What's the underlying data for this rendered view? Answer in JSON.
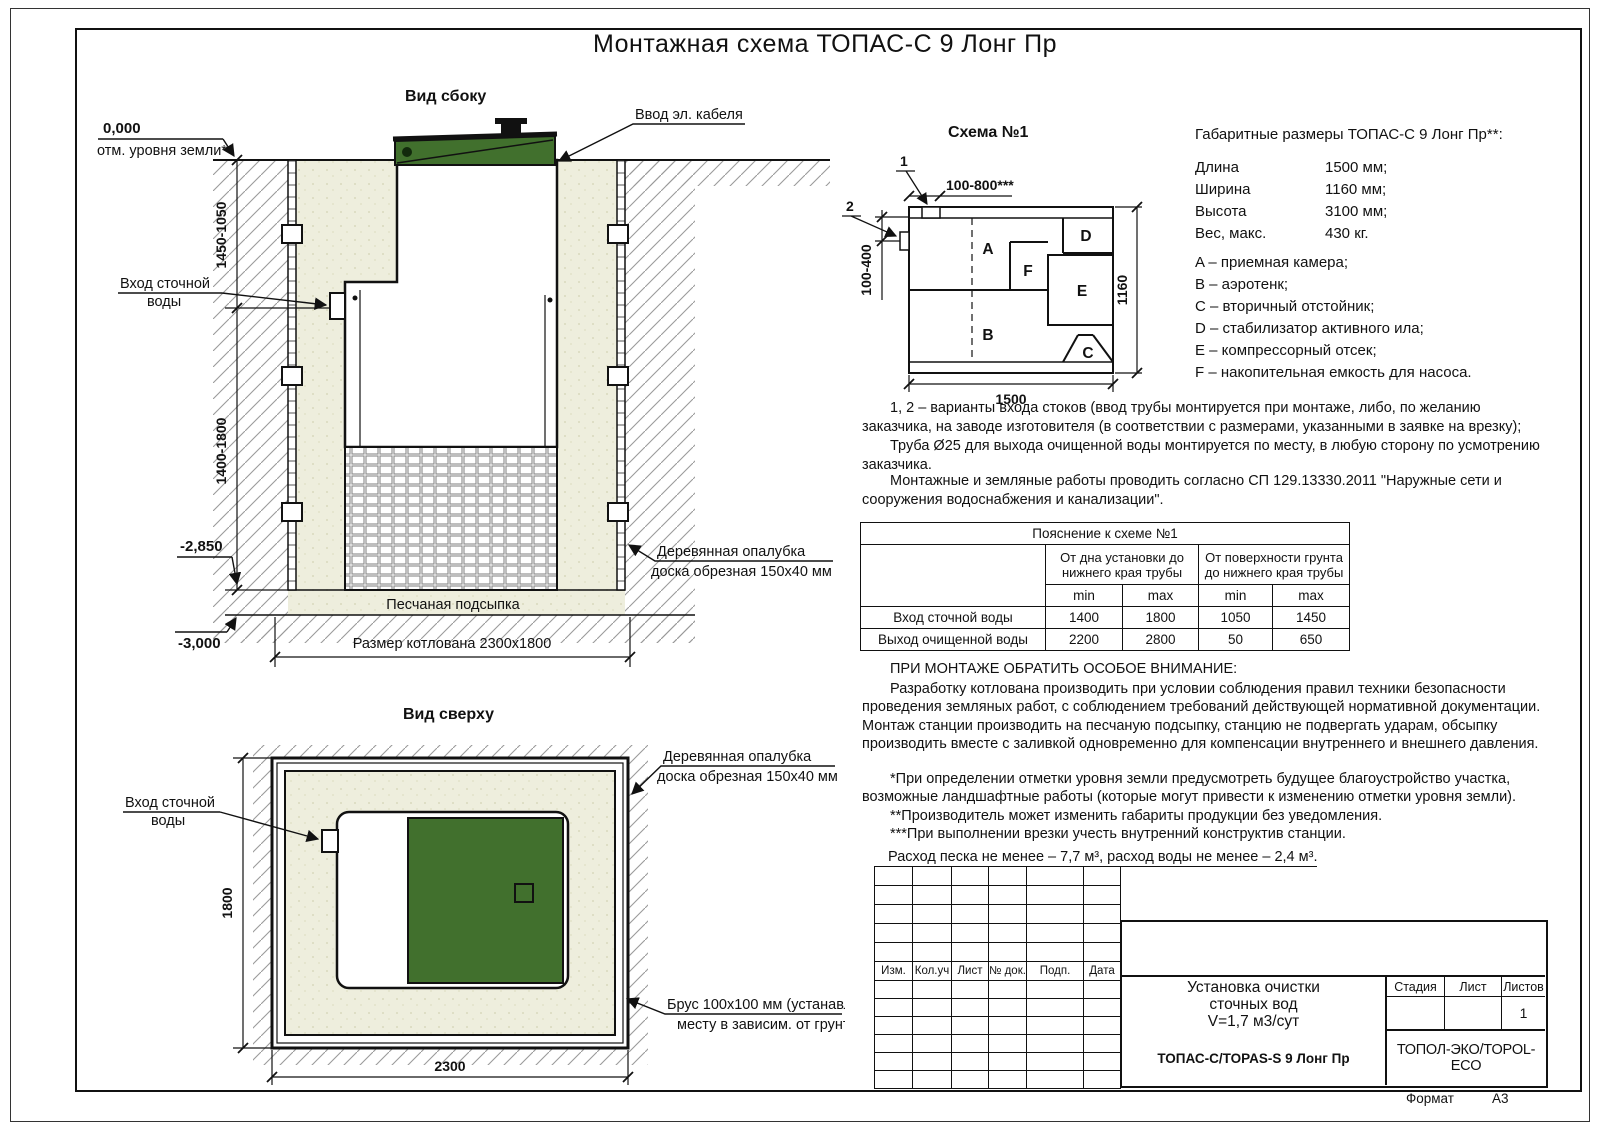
{
  "colors": {
    "green": "#41702d",
    "sand": "#eeeedd",
    "line": "#111111"
  },
  "sheet": {
    "title": "Монтажная схема ТОПАС-С 9 Лонг Пр",
    "format_label": "Формат",
    "format_value": "А3"
  },
  "side_view": {
    "view_label": "Вид сбоку",
    "zero_mark": "0,000",
    "zero_sub": "отм. уровня земли*",
    "cable_label": "Ввод эл. кабеля",
    "dim_upper": "1450-1050",
    "dim_lower": "1400-1800",
    "inlet1": "Вход сточной",
    "inlet2": "воды",
    "mark_2850": "-2,850",
    "mark_3000": "-3,000",
    "formwork1": "Деревянная опалубка",
    "formwork2": "доска обрезная 150х40 мм",
    "sand_label": "Песчаная подсыпка",
    "pit_label": "Размер котлована 2300х1800"
  },
  "top_view": {
    "view_label": "Вид сверху",
    "inlet1": "Вход сточной",
    "inlet2": "воды",
    "formwork1": "Деревянная опалубка",
    "formwork2": "доска обрезная 150х40 мм",
    "beam1": "Брус 100х100 мм (устанавл. по",
    "beam2": "месту в зависим. от грунта)",
    "dim_h": "1800",
    "dim_w": "2300"
  },
  "schema1": {
    "title": "Схема №1",
    "mark1": "1",
    "mark2": "2",
    "dim_top": "100-800***",
    "dim_left": "100-400",
    "dim_bottom": "1500",
    "dim_right": "1160",
    "comp": {
      "a": "A",
      "b": "B",
      "c": "C",
      "d": "D",
      "e": "E",
      "f": "F"
    }
  },
  "overall_dims": {
    "title": "Габаритные размеры ТОПАС-С 9 Лонг Пр**:",
    "rows": [
      {
        "name": "Длина",
        "value": "1500 мм;"
      },
      {
        "name": "Ширина",
        "value": "1160 мм;"
      },
      {
        "name": "Высота",
        "value": "3100 мм;"
      },
      {
        "name": "Вес, макс.",
        "value": "430 кг."
      }
    ]
  },
  "legend": {
    "items": [
      "A – приемная камера;",
      "B – аэротенк;",
      "C – вторичный отстойник;",
      "D – стабилизатор активного ила;",
      "E – компрессорный отсек;",
      "F – накопительная емкость для насоса."
    ]
  },
  "notes": {
    "variants": "1, 2 – варианты входа  стоков (ввод трубы монтируется при монтаже, либо, по желанию заказчика, на заводе изготовителя (в соответствии с размерами, указанными в заявке на врезку);",
    "pipe": "Труба Ø25 для выхода очищенной воды монтируется по месту, в любую сторону по усмотрению заказчика.",
    "works": "Монтажные и земляные работы проводить согласно СП 129.13330.2011 \"Наружные сети и сооружения водоснабжения и канализации\"."
  },
  "table": {
    "title": "Пояснение к схеме №1",
    "group1": "От дна установки до нижнего края трубы",
    "group2": "От поверхности грунта до нижнего края трубы",
    "min_label": "min",
    "max_label": "max",
    "rows": [
      {
        "name": "Вход сточной воды",
        "v1": "1400",
        "v2": "1800",
        "v3": "1050",
        "v4": "1450"
      },
      {
        "name": "Выход очищенной воды",
        "v1": "2200",
        "v2": "2800",
        "v3": "50",
        "v4": "650"
      }
    ]
  },
  "attention": {
    "title": "ПРИ МОНТАЖЕ ОБРАТИТЬ ОСОБОЕ ВНИМАНИЕ:",
    "p1": "Разработку котлована производить при условии соблюдения правил техники безопасности проведения земляных работ, с соблюдением требований действующей нормативной документации. Монтаж станции производить на песчаную подсыпку, станцию не подвергать ударам, обсыпку производить вместе с заливкой одновременно для компенсации внутреннего и внешнего давления.",
    "note1": "*При определении отметки уровня земли предусмотреть будущее благоустройство участка, возможные ландшафтные работы (которые могут привести к изменению отметки уровня земли).",
    "note2": "**Производитель может изменить габариты продукции без уведомления.",
    "note3": "***При выполнении врезки учесть внутренний конструктив станции.",
    "consumption": "Расход песка не менее – 7,7 м³, расход воды не менее – 2,4 м³."
  },
  "title_block": {
    "cols": [
      "Изм.",
      "Кол.уч",
      "Лист",
      "№ док.",
      "Подп.",
      "Дата"
    ],
    "doc1": "Установка очистки",
    "doc2": "сточных вод",
    "doc3": "V=1,7 м3/сут",
    "stage": "Стадия",
    "sheet": "Лист",
    "sheets": "Листов",
    "sheets_val": "1",
    "model": "ТОПАС-С/TOPAS-S 9 Лонг Пр",
    "company": "ТОПОЛ-ЭКО/TOPOL-ECO"
  }
}
